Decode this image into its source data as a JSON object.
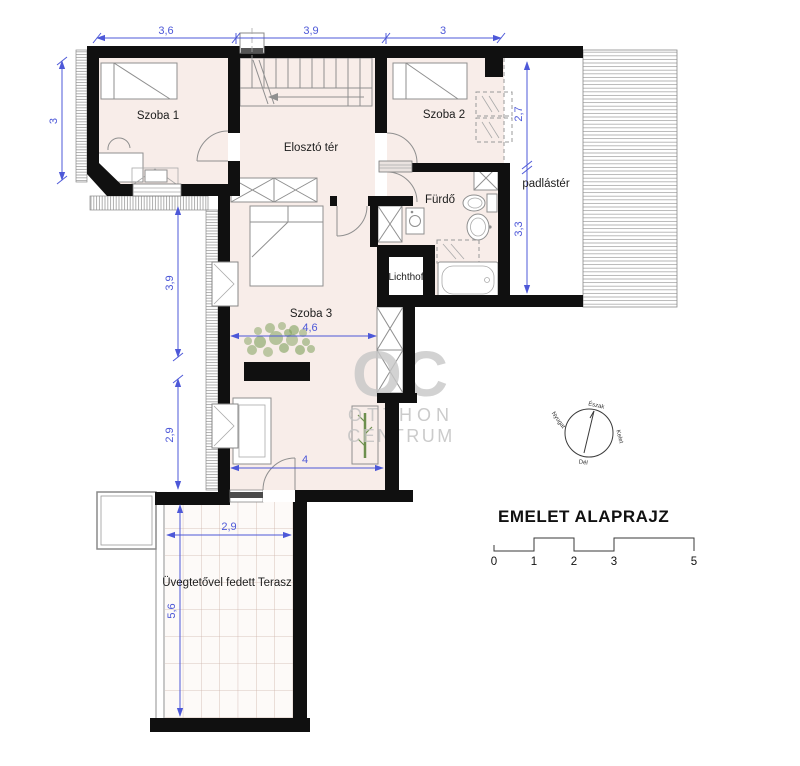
{
  "plan": {
    "rooms": {
      "szoba1": "Szoba 1",
      "szoba2": "Szoba 2",
      "eloszto": "Elosztó tér",
      "furdo": "Fürdő",
      "padlas": "padlástér",
      "lichthof": "Lichthof",
      "szoba3": "Szoba 3",
      "terasz": "Üvegtetővel fedett Terasz"
    },
    "dims": {
      "top": [
        "3,6",
        "3,9",
        "3"
      ],
      "left": "3",
      "padlas": [
        "2,7",
        "3,3"
      ],
      "szoba3_left": [
        "3,9",
        "2,9"
      ],
      "szoba3_mid": "4,6",
      "szoba3_bottom": "4",
      "terasz_w": "2,9",
      "terasz_h": "5,6"
    }
  },
  "legend": {
    "title": "EMELET ALAPRAJZ",
    "scale": [
      "0",
      "1",
      "2",
      "3",
      "5"
    ]
  },
  "compass": {
    "north": "Észak",
    "east": "Kelet",
    "south": "Dél",
    "west": "Nyugat"
  },
  "watermark": {
    "logo": "OC",
    "line1": "OTTHON",
    "line2": "CENTRUM"
  },
  "colors": {
    "dimension_blue": "#4d58d8",
    "wall_black": "#101010",
    "room_fill": "#f8ede9",
    "terrace_grid": "#cdb4ab",
    "hatch_gray": "#7a7a7a",
    "furniture_gray": "#8f8f8f",
    "watermark_gray": "#c7c7c7",
    "plant_green": "#7fa05c"
  }
}
